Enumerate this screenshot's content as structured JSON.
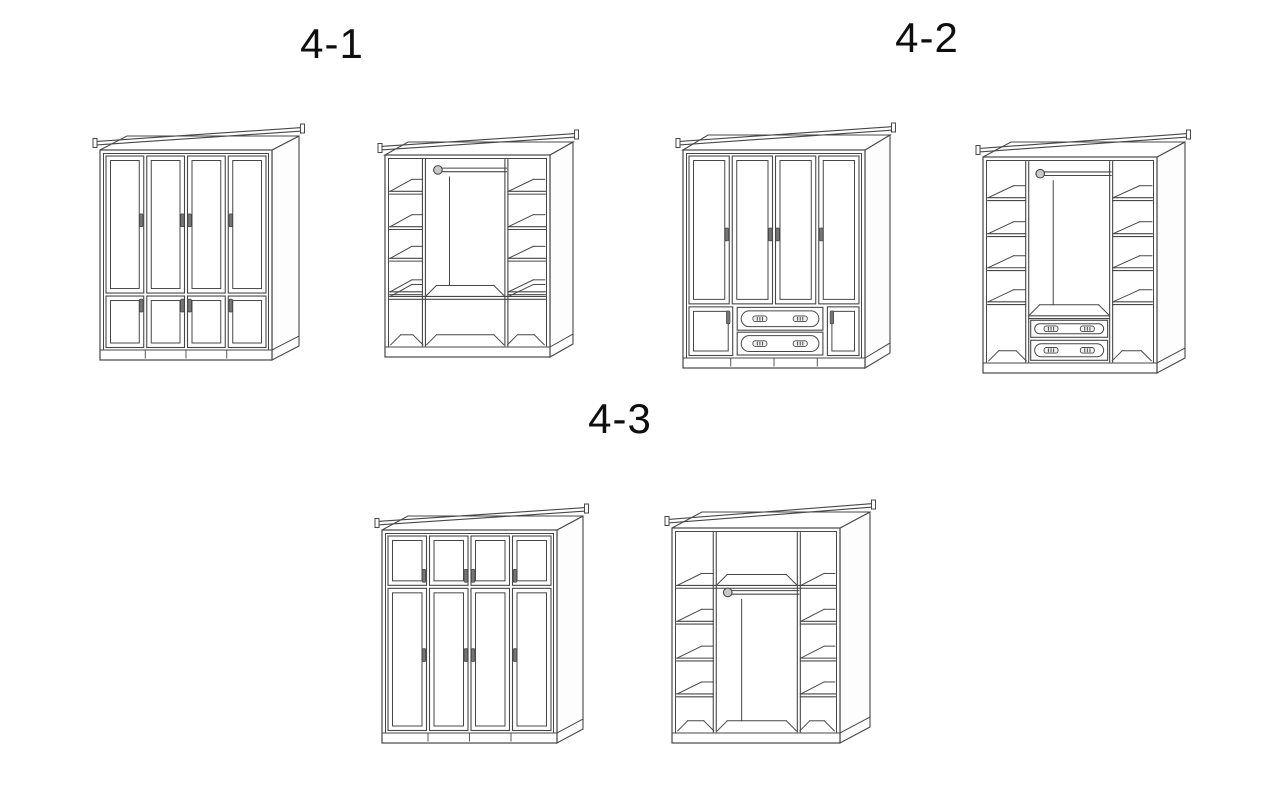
{
  "page": {
    "background": "#ffffff",
    "line_color": "#474747",
    "label_color": "#0e0e0e",
    "handle_color": "#757575",
    "rod_fill": "#c9c9c9"
  },
  "figure": {
    "groups": [
      {
        "label": "4-1",
        "label_x": 332,
        "label_y": 44,
        "items": [
          {
            "name": "wardrobe-4-1-exterior",
            "view": "exterior",
            "style": "two-rows-of-doors",
            "geom": {
              "x": 100,
              "y": 150,
              "w": 172,
              "h": 210,
              "dx": 27,
              "dy": -14
            },
            "params": {
              "rowSplit": 0.72,
              "order": "tall-top",
              "tallHandleFrac": 0.47
            }
          },
          {
            "name": "wardrobe-4-1-interior",
            "view": "interior",
            "style": "shelves-rod-open-bottom",
            "geom": {
              "x": 385,
              "y": 155,
              "w": 165,
              "h": 202,
              "dx": 23,
              "dy": -13
            },
            "params": {
              "cols": [
                0.22,
                0.75
              ],
              "rodFrac": 0.055,
              "shelves": [
                0.17,
                0.36,
                0.53,
                0.71
              ],
              "bottomShelf": 0.735
            }
          }
        ]
      },
      {
        "label": "4-2",
        "label_x": 927,
        "label_y": 38,
        "items": [
          {
            "name": "wardrobe-4-2-exterior",
            "view": "exterior",
            "style": "doors-with-drawers",
            "geom": {
              "x": 683,
              "y": 150,
              "w": 182,
              "h": 218,
              "dx": 25,
              "dy": -15
            },
            "params": {
              "rowSplit": 0.745,
              "sideDoorL": 0.27,
              "sideDoorR": 0.2,
              "tallHandleFrac": 0.53
            }
          },
          {
            "name": "wardrobe-4-2-interior",
            "view": "interior",
            "style": "shelves-rod-drawers",
            "geom": {
              "x": 983,
              "y": 157,
              "w": 174,
              "h": 216,
              "dx": 28,
              "dy": -15
            },
            "params": {
              "cols": [
                0.24,
                0.75
              ],
              "rodFrac": 0.06,
              "shelves": [
                0.18,
                0.36,
                0.53,
                0.7
              ],
              "drawerTop": 0.77,
              "drawerMid": 0.885
            }
          }
        ]
      },
      {
        "label": "4-3",
        "label_x": 620,
        "label_y": 419,
        "items": [
          {
            "name": "wardrobe-4-3-exterior",
            "view": "exterior",
            "style": "two-rows-of-doors",
            "geom": {
              "x": 382,
              "y": 530,
              "w": 175,
              "h": 213,
              "dx": 26,
              "dy": -14
            },
            "params": {
              "rowSplit": 0.265,
              "order": "small-top",
              "tallHandleFrac": 0.47
            }
          },
          {
            "name": "wardrobe-4-3-interior",
            "view": "interior",
            "style": "top-row-shelves-rod",
            "geom": {
              "x": 672,
              "y": 528,
              "w": 168,
              "h": 215,
              "dx": 30,
              "dy": -16
            },
            "params": {
              "cols": [
                0.24,
                0.77
              ],
              "topRow": 0.265,
              "rodFrac": 0.3,
              "shelves": [
                0.445,
                0.63,
                0.81
              ]
            }
          }
        ]
      }
    ]
  }
}
